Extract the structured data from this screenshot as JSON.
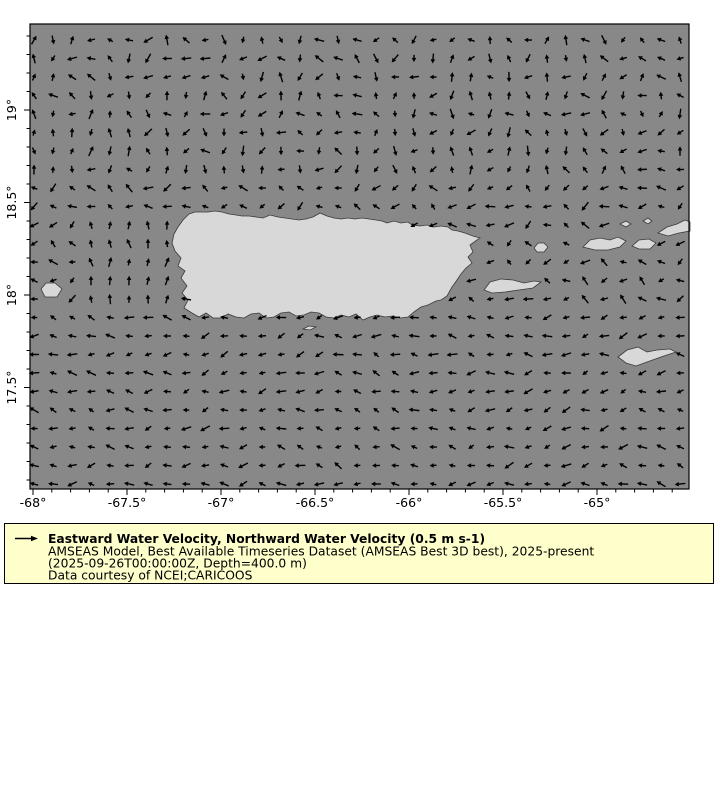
{
  "figure": {
    "title": "Eastward Water Velocity, Northward Water Velocity map around Puerto Rico"
  },
  "axes": {
    "x_tick_labels": [
      "-68°",
      "-67.5°",
      "-67°",
      "-66.5°",
      "-66°",
      "-65.5°",
      "-65°"
    ],
    "x_tick_lons": [
      -68,
      -67.5,
      -67,
      -66.5,
      -66,
      -65.5,
      -65
    ],
    "y_tick_labels": [
      "19°",
      "18.5°",
      "18°",
      "17.5°"
    ],
    "y_tick_lats": [
      19,
      18.5,
      18,
      17.5
    ],
    "minor_tick_step_deg": 0.1,
    "lon_range": [
      -68.02,
      -64.5
    ],
    "lat_range": [
      16.95,
      19.47
    ]
  },
  "legend": {
    "title": "Eastward Water Velocity, Northward Water Velocity (0.5 m s-1)",
    "line2": "AMSEAS Model, Best Available Timeseries Dataset (AMSEAS Best 3D best), 2025-present",
    "line3": "(2025-09-26T00:00:00Z, Depth=400.0 m)",
    "line4": "Data courtesy of NCEI;CARICOOS",
    "reference_arrow_value": "0.5 m s-1",
    "background_color": "#ffffcc",
    "border_color": "#000000"
  },
  "map": {
    "sea_color": "#888888",
    "land_color": "#d8d8d8",
    "coast_color": "#3a3a3a",
    "arrow_color": "#000000",
    "land_features": [
      "puerto-rico",
      "mona",
      "vieques",
      "culebra",
      "st-thomas",
      "st-john",
      "tortola-virgin-gorda",
      "islets",
      "st-croix",
      "caja-de-muertos"
    ]
  },
  "vector_field": {
    "grid": {
      "x0": 34,
      "y0": 40,
      "dx": 19.0,
      "dy": 18.5,
      "cols": 35,
      "rows": 25
    },
    "length_px_min": 6.5,
    "length_px_var": 4.5,
    "hash_consts": [
      12.9898,
      78.233,
      43758.5453
    ],
    "regions": [
      {
        "name": "mona-passage-northward",
        "x_min": 85,
        "x_max": 178,
        "y_min": 222,
        "y_max": 308,
        "base_angle_deg": 90,
        "jitter_deg": 50
      },
      {
        "name": "north-atlantic-variable",
        "y_max": 180,
        "base_angle_deg": 180,
        "jitter_deg": 240
      },
      {
        "name": "island-band-mixed",
        "y_max": 310,
        "base_angle_deg": 180,
        "jitter_deg": 120
      },
      {
        "name": "caribbean-westward",
        "y_max": 9999,
        "base_angle_deg": 180,
        "jitter_deg": 64
      }
    ]
  }
}
